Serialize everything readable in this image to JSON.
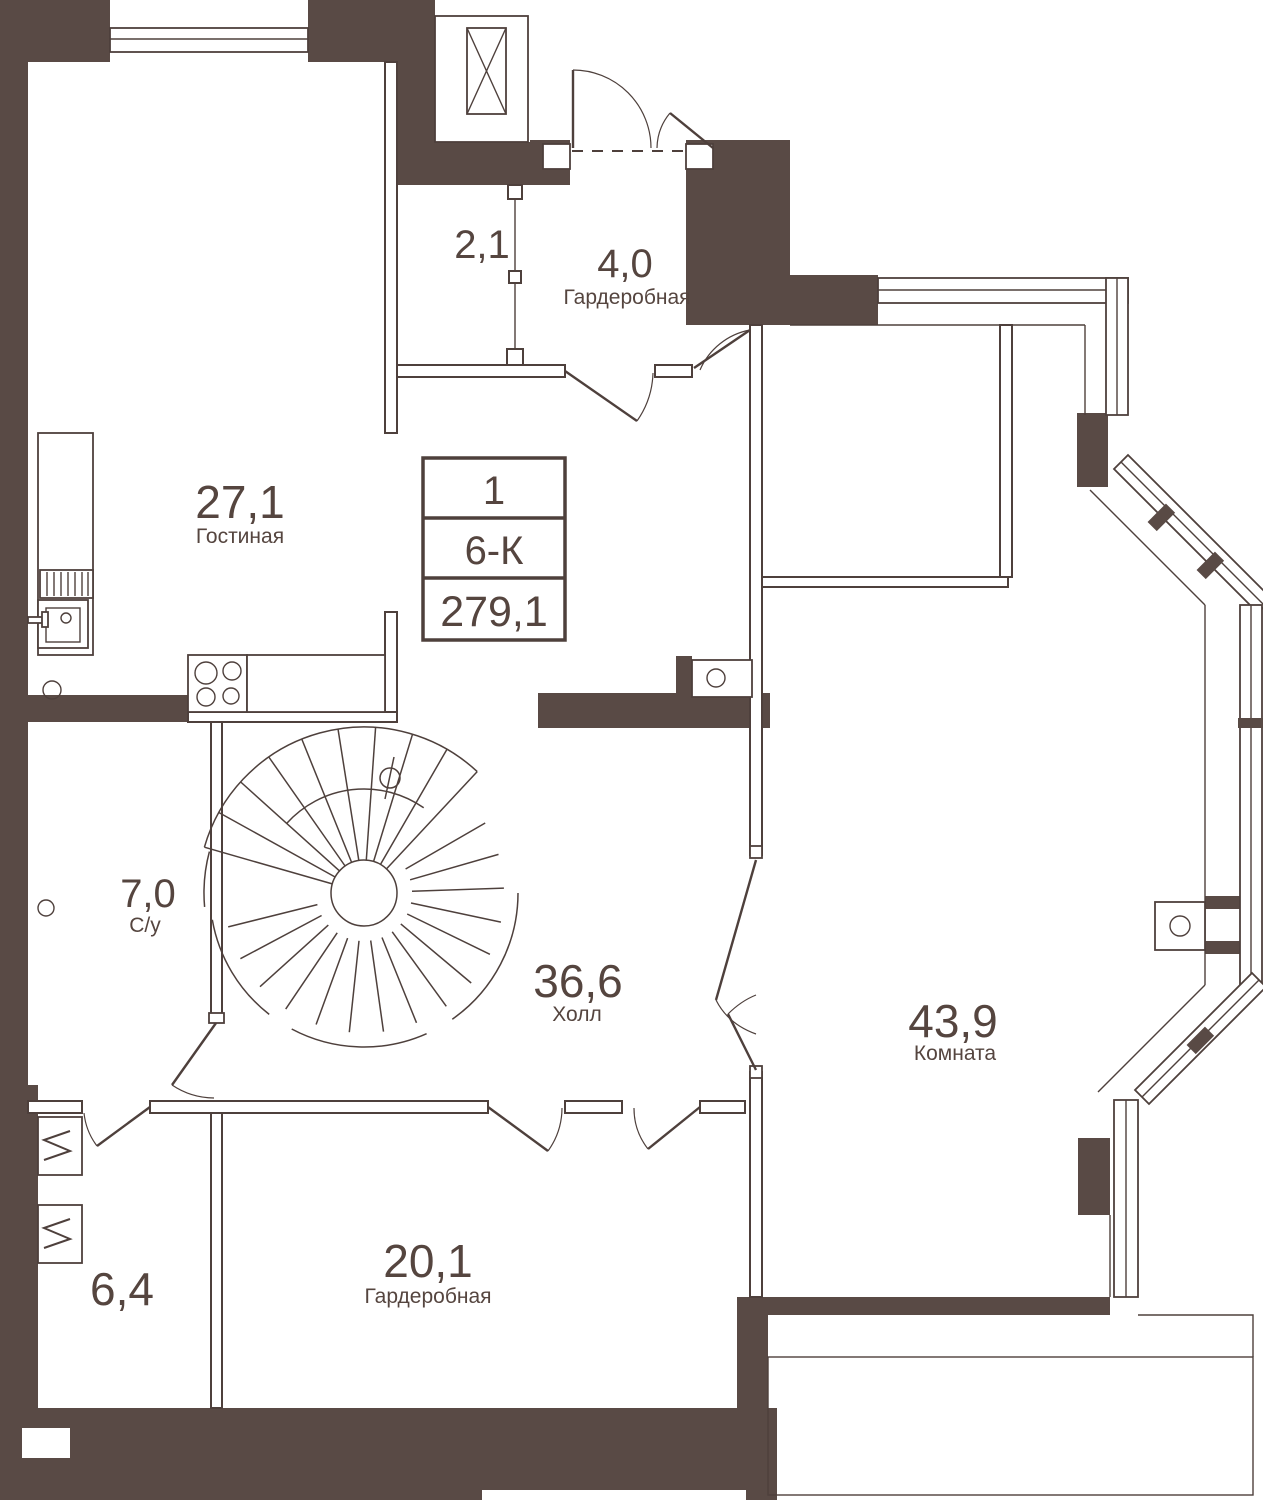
{
  "plan": {
    "unit": {
      "number": "1",
      "layout": "6-К",
      "total_area": "279,1"
    },
    "rooms": [
      {
        "id": "corridor",
        "area": "2,1",
        "name": ""
      },
      {
        "id": "wardrobe-top",
        "area": "4,0",
        "name": "Гардеробная"
      },
      {
        "id": "living-room",
        "area": "27,1",
        "name": "Гостиная"
      },
      {
        "id": "bathroom",
        "area": "7,0",
        "name": "С/у"
      },
      {
        "id": "hall",
        "area": "36,6",
        "name": "Холл"
      },
      {
        "id": "room",
        "area": "43,9",
        "name": "Комната"
      },
      {
        "id": "laundry",
        "area": "6,4",
        "name": ""
      },
      {
        "id": "wardrobe-bottom",
        "area": "20,1",
        "name": "Гардеробная"
      }
    ],
    "colors": {
      "wall": "#594a45",
      "line": "#4e403c",
      "text": "#55453f",
      "background": "#ffffff"
    }
  }
}
